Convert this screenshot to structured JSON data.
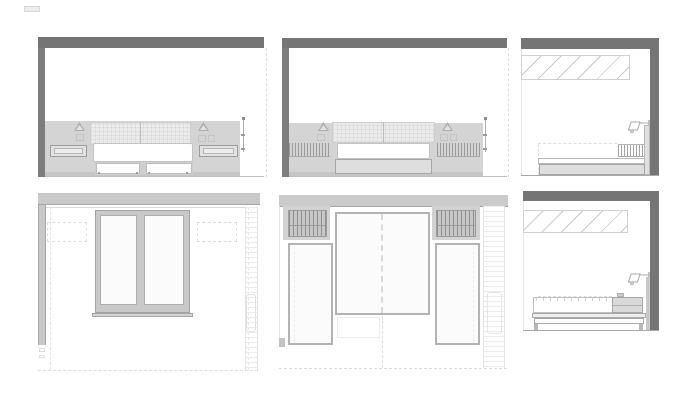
{
  "sheet": {
    "kind": "architectural-drawing-sheet",
    "text_content": "none",
    "panels": [
      {
        "id": "elevation-bed-nightstands",
        "row": 1,
        "col": 1,
        "features": [
          "ceiling-slab",
          "wall-section",
          "headboard",
          "wall-lamp",
          "nightstand",
          "bed",
          "under-bed-drawers",
          "dimension-line"
        ]
      },
      {
        "id": "elevation-bed-bookshelves",
        "row": 1,
        "col": 2,
        "features": [
          "ceiling-slab",
          "wall-section",
          "headboard",
          "wall-lamp",
          "book-row",
          "bed",
          "bed-base",
          "dimension-line"
        ]
      },
      {
        "id": "section-bed-a",
        "row": 1,
        "col": 3,
        "features": [
          "ceiling-slab",
          "wall-section",
          "clerestory-glazing",
          "wall-lamp",
          "book-row",
          "bed-profile"
        ]
      },
      {
        "id": "elevation-window-wall",
        "row": 2,
        "col": 1,
        "features": [
          "beam-band",
          "wall-column",
          "double-window",
          "window-sill",
          "dashed-guides",
          "hatched-strip"
        ]
      },
      {
        "id": "elevation-wardrobe-bed",
        "row": 2,
        "col": 2,
        "features": [
          "beam-band",
          "louver-panel",
          "center-bed-panel",
          "wardrobe-door",
          "dashed-centerline",
          "hatched-strip"
        ]
      },
      {
        "id": "section-bed-b",
        "row": 2,
        "col": 3,
        "features": [
          "ceiling-slab",
          "wall-section",
          "clerestory-glazing",
          "wall-lamp",
          "mattress",
          "nightstand",
          "bed-frame"
        ]
      }
    ]
  },
  "palette": {
    "paper": "#ffffff",
    "slab": "#757575",
    "wall_stripe": "#7d7d7d",
    "wall_band": "#d4d4d4",
    "wall_band_floor": "#c6c6c6",
    "band_light": "#c9c9c9",
    "headboard": "#ebebeb",
    "furniture_fill": "#dedede",
    "furniture_line": "#a6a6a6",
    "pane": "#fbfbfb",
    "outline_soft": "#b3b3b3",
    "hatch_dark": "#9b9b9b",
    "hatch_soft": "#c9c9c9",
    "dash_faint": "#dedede",
    "dim_line": "#9a9a9a",
    "floor_line": "#bdbdbd"
  }
}
